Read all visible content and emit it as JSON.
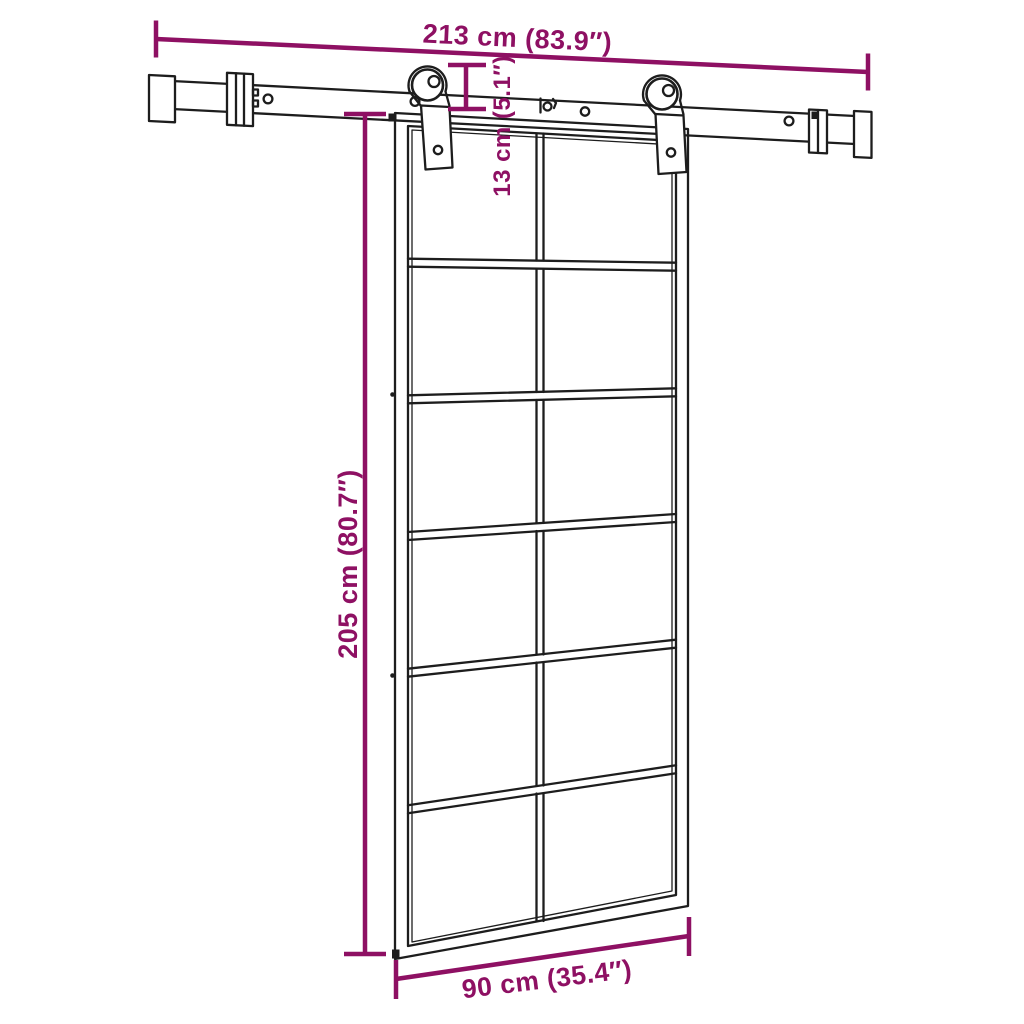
{
  "figure": {
    "type": "product dimension diagram",
    "subject": "Sliding glass door with overhead sliding rail and two roller hangers"
  },
  "colors": {
    "dimension_accent": "#8E1063",
    "line_art": "#1D1D1D",
    "background": "#FFFFFF"
  },
  "dimensions": {
    "track_length": "213 cm (83.9″)",
    "door_height": "205 cm (80.7″)",
    "hanger_height": "13 cm (5.1″)",
    "door_width": "90 cm (35.4″)"
  },
  "door": {
    "glass_rows": "6",
    "glass_columns": "2",
    "panel_count": "12"
  }
}
